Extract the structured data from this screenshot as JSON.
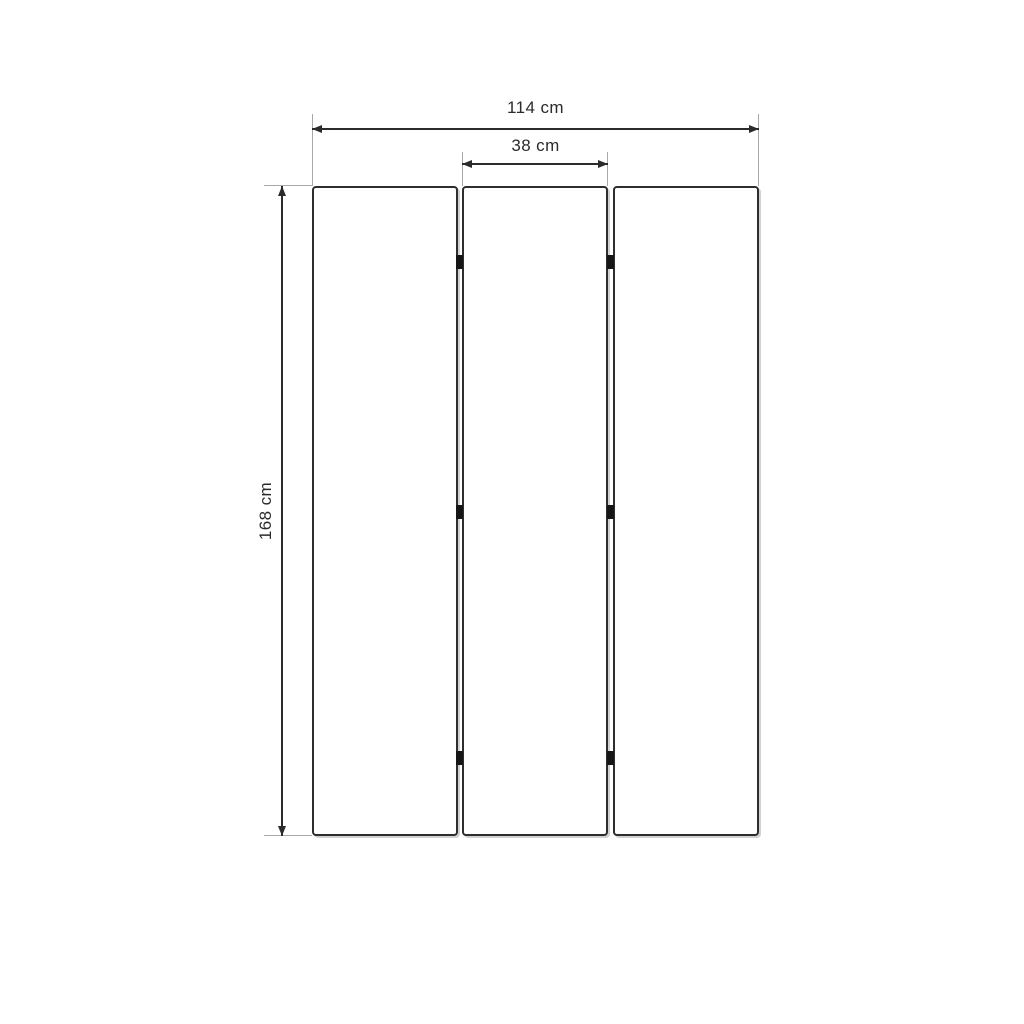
{
  "diagram": {
    "kind": "furniture-dimension-drawing",
    "dimensions": {
      "overall_width": {
        "label": "114 cm",
        "value": 114,
        "unit": "cm"
      },
      "panel_width": {
        "label": "38 cm",
        "value": 38,
        "unit": "cm"
      },
      "height": {
        "label": "168 cm",
        "value": 168,
        "unit": "cm"
      }
    },
    "panels": {
      "count": 3
    },
    "hinges": {
      "count": 6
    }
  },
  "colors": {
    "background": "#ffffff",
    "dimension_line": "#2b2b2b",
    "extension_line": "#a9a9a9",
    "panel_border": "#2e2e2e",
    "hinge": "#161616",
    "label_text": "#2b2b2b"
  }
}
